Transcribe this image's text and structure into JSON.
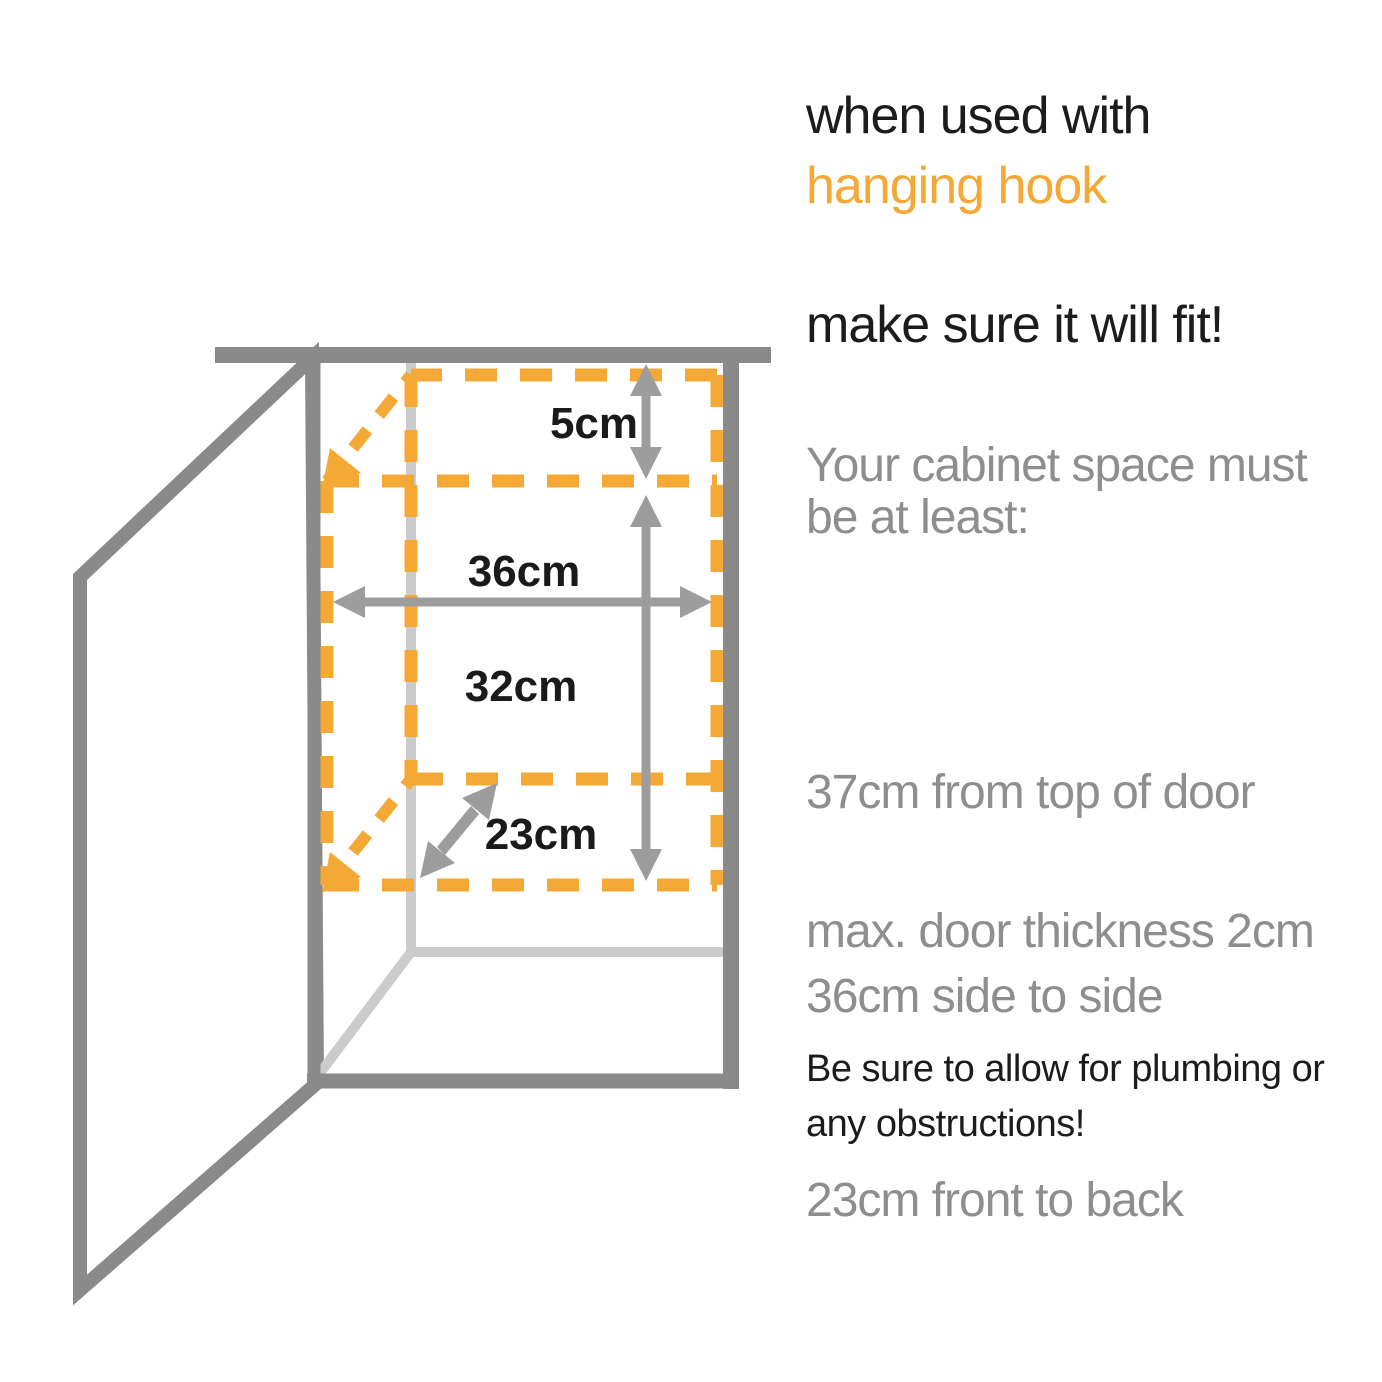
{
  "page": {
    "background": "#ffffff"
  },
  "colors": {
    "accent_orange": "#f4a836",
    "cabinet_gray": "#8a8a8a",
    "interior_light_gray": "#cbcbcb",
    "arrow_gray": "#9d9d9d",
    "text_black": "#1c1c1c",
    "text_gray": "#8e8e8e"
  },
  "heading": {
    "line1": "when used with",
    "line2": "hanging hook",
    "line3": "make sure it will fit!"
  },
  "requirements": {
    "intro": "Your cabinet space must be at least:",
    "items": [
      "37cm from top of door",
      "36cm side to side",
      "23cm front to back"
    ],
    "door_note": "max. door thickness 2cm"
  },
  "warning": "Be sure to allow for plumbing or any obstructions!",
  "diagram": {
    "description": "open cabinet with dashed clearance box",
    "labels": {
      "top_clearance": "5cm",
      "width": "36cm",
      "height": "32cm",
      "depth": "23cm"
    }
  }
}
